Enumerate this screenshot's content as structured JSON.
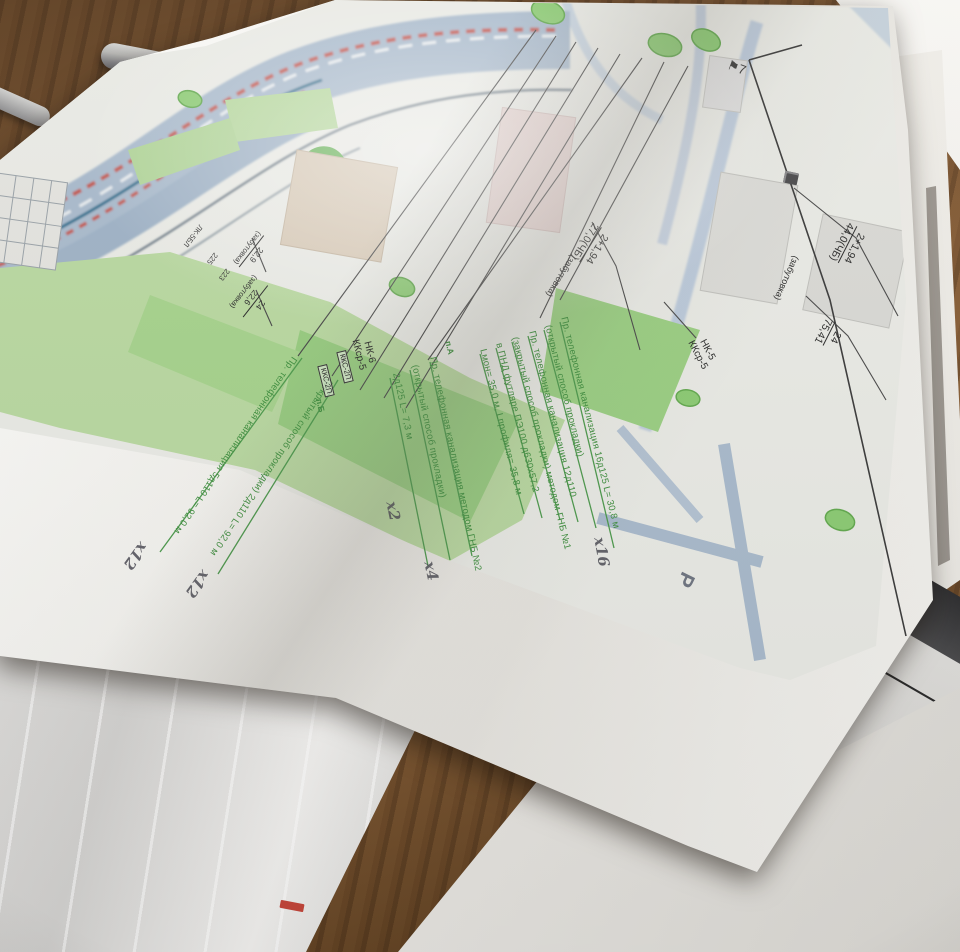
{
  "colors": {
    "ink_green": "#3f8f3f",
    "ink_black": "#2b2b2b",
    "pencil_graphite": "#4b4b54",
    "lawn_green": "#b9d8a1",
    "road_blue": "#a9bacc",
    "track_red": "#c25b52",
    "desk_wood": "#76522f"
  },
  "map": {
    "green_annotations": [
      "Пр. телефонная канализация 16д125 L= 30,8 м",
      "(открытый способ прокладки)",
      "Пр. телефонная канализация 12д110",
      "(закрытый способ прокладки) методом ГНБ №1",
      "в ПНД футляре ПЭ100 д630х57,2",
      "Lмон= 35,0 м, Lпрофиля= 35,8 м",
      "Пр. телефонная канализация методом ГНБ №2",
      "(открытый способ прокладки)",
      "2д125 L= 7,3 м",
      "Пр. телефонная канализация 5д110 L= 92,0 м",
      "(открытый способ прокладки) 2д110 L= 92,0 м"
    ],
    "pencil_marks": [
      "х16",
      "х2",
      "х4",
      "х12",
      "х12"
    ],
    "dimension_callouts": [
      {
        "top": "2+1,94",
        "bottom": "44,0(ЧБ)",
        "note": "(забутовка)"
      },
      {
        "top": "24",
        "bottom": "75,41"
      },
      {
        "top": "2+1,94",
        "bottom": "27,0(ЧБ)",
        "note": "(забутовка)"
      },
      {
        "top": "22,9",
        "note": "(забутовка)"
      },
      {
        "top": "24",
        "bottom": "22,6",
        "note": "(забутовка)"
      }
    ],
    "well_callouts": [
      {
        "line1": "НК-5",
        "line2": "ККср-5"
      },
      {
        "line1": "НК-6",
        "line2": "ККср-5"
      }
    ],
    "boxed_labels": [
      "ККС-2П",
      "ККС-2П"
    ],
    "tiny_labels": [
      "ЛК-5БЛ",
      "225",
      "223"
    ],
    "point_markers": [
      "п.А",
      "п.Б"
    ],
    "parking_label": "Р",
    "route_marker": "7"
  },
  "underlying_document": {
    "email_fragment": "nfo@",
    "text_fragment_1": "о   при",
    "text_fragment_2": "которы"
  }
}
